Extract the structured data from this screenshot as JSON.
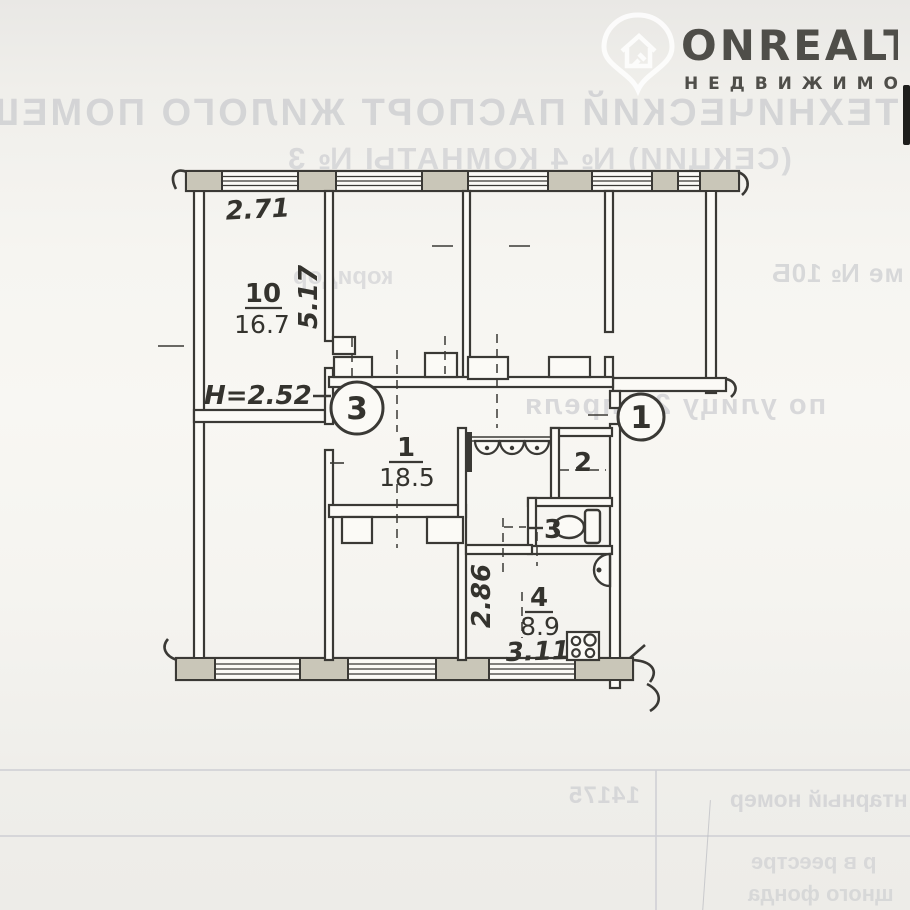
{
  "watermark": {
    "brand": "ONREALT",
    "tagline": "Н Е Д В И Ж И М О С Т Ь"
  },
  "bleedthrough": {
    "doc_title": "ТЕХНИЧЕСКИЙ ПАСПОРТ ЖИЛОГО ПОМЕЩЕНИЯ",
    "doc_subtitle": "(СЕКЦИИ) № 4 КОМНАТЫ № 3",
    "corridor_note": "коридор",
    "house_note": "ме № 10Б",
    "street_note": "по улицу 2 Апреля",
    "inventory_label": "нтарный номер",
    "inventory_value": "14175",
    "registry_line1": "р в реестре",
    "registry_line2": "щного фонда"
  },
  "plan": {
    "ceiling_height": "H=2.52",
    "dim_top_width": "2.71",
    "dim_left_depth": "5.17",
    "dim_kitchen_depth": "2.86",
    "dim_kitchen_width": "3.11",
    "rooms": [
      {
        "number": "10",
        "area": "16.7"
      },
      {
        "number": "1",
        "area": "18.5"
      },
      {
        "number": "2"
      },
      {
        "number": "3"
      },
      {
        "number": "4",
        "area": "8.9"
      }
    ],
    "entry_markers": [
      "3",
      "1"
    ]
  },
  "colors": {
    "ink": "#3a3935",
    "pier_fill": "#c9c6b8",
    "bleed_text": "#c3c5ca",
    "table_line": "#cfd0d5"
  }
}
